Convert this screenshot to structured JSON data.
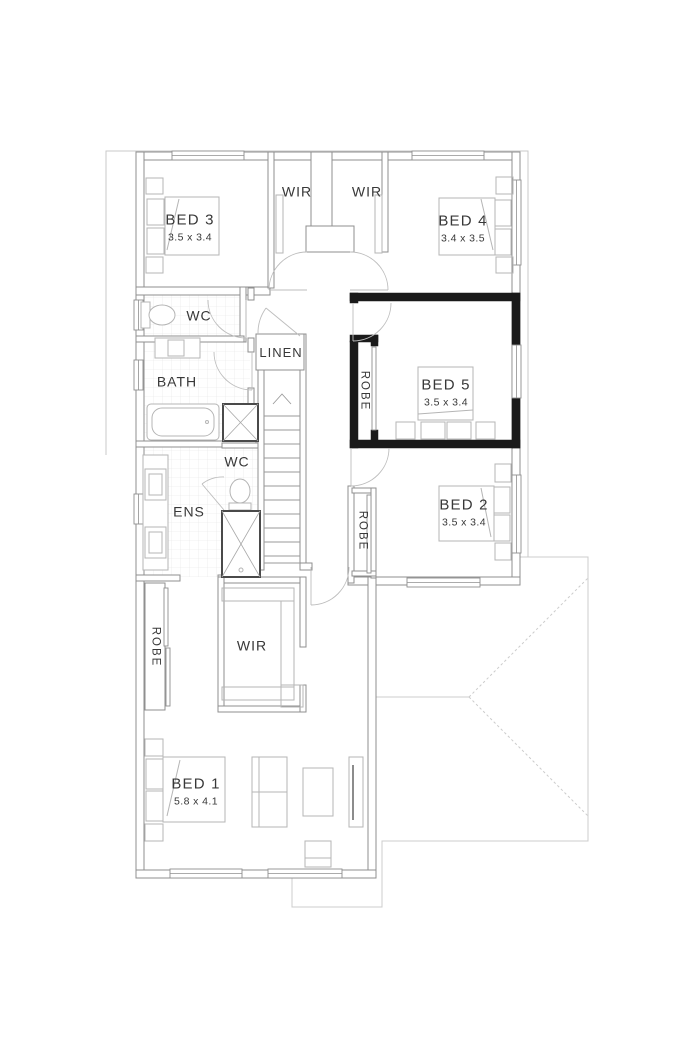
{
  "plan": {
    "type": "floor-plan",
    "floor": "upper-floor",
    "colors": {
      "wall": "#8f8f8f",
      "highlight_wall": "#1a1a1a",
      "furniture": "#b5b5b5",
      "boundary": "#c9c9c9",
      "text": "#383838",
      "background": "#ffffff"
    },
    "rooms": [
      {
        "id": "bed3",
        "label": "BED 3",
        "dims": "3.5 x 3.4"
      },
      {
        "id": "wir-top-left",
        "label": "WIR"
      },
      {
        "id": "wir-top-right",
        "label": "WIR"
      },
      {
        "id": "bed4",
        "label": "BED 4",
        "dims": "3.4 x 3.5"
      },
      {
        "id": "wc-upper",
        "label": "WC"
      },
      {
        "id": "bath",
        "label": "BATH"
      },
      {
        "id": "linen",
        "label": "LINEN"
      },
      {
        "id": "bed5",
        "label": "BED 5",
        "dims": "3.5 x 3.4"
      },
      {
        "id": "robe-bed5",
        "label": "ROBE"
      },
      {
        "id": "ens",
        "label": "ENS"
      },
      {
        "id": "wc-ens",
        "label": "WC"
      },
      {
        "id": "bed2",
        "label": "BED 2",
        "dims": "3.5 x 3.4"
      },
      {
        "id": "robe-bed2",
        "label": "ROBE"
      },
      {
        "id": "robe-bed1",
        "label": "ROBE"
      },
      {
        "id": "wir-bed1",
        "label": "WIR"
      },
      {
        "id": "bed1",
        "label": "BED 1",
        "dims": "5.8 x 4.1"
      }
    ]
  }
}
